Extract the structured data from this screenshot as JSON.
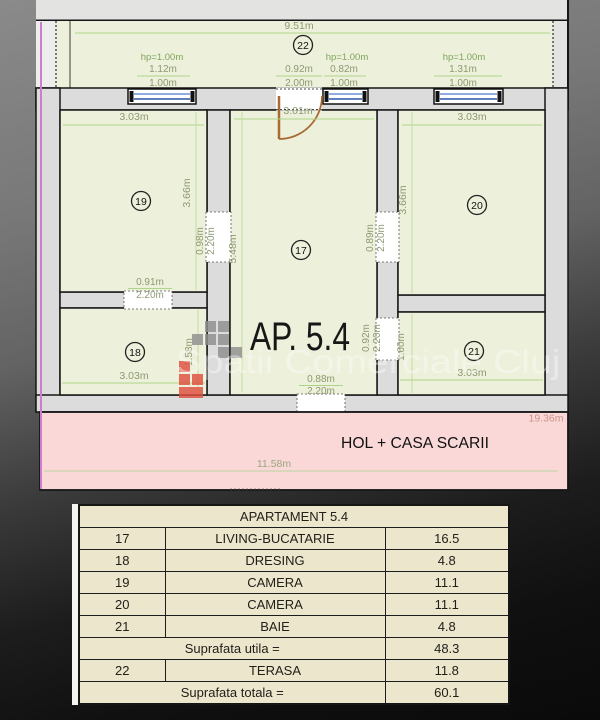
{
  "plan": {
    "apartment_label": "AP. 5.4",
    "watermark_text": "Spatii Comerciale Cluj",
    "terrace": {
      "number": "22",
      "width_total": "9.51m",
      "hp_left": "hp=1.00m",
      "hp_mid": "hp=1.00m",
      "hp_right": "hp=1.00m",
      "win_left_w": "1.12m",
      "win_left_h": "1.00m",
      "door_w": "0.92m",
      "door_h": "2.00m",
      "win_mid_w": "0.82m",
      "win_mid_h": "1.00m",
      "win_right_w": "1.31m",
      "win_right_h": "1.00m"
    },
    "room17": {
      "number": "17",
      "width": "3.01m",
      "height": "5.48m",
      "door_left_w": "0.98m",
      "door_left_h": "2.20m",
      "door_right_w": "0.89m",
      "door_right_h": "2.20m",
      "door_bath_w": "0.92m",
      "door_bath_h": "2.20m",
      "entry_w": "0.88m",
      "entry_h": "2.20m"
    },
    "room18": {
      "number": "18",
      "width": "3.03m",
      "height": "1.58m"
    },
    "room19": {
      "number": "19",
      "width": "3.03m",
      "height": "3.66m",
      "pass_w": "0.91m",
      "pass_h": "2.20m"
    },
    "room20": {
      "number": "20",
      "width": "3.03m",
      "height": "3.66m"
    },
    "room21": {
      "number": "21",
      "width": "3.03m",
      "height": "1.60m"
    },
    "hall": {
      "label": "HOL + CASA SCARII",
      "width": "11.58m",
      "width_total": "19.36m"
    }
  },
  "table": {
    "title": "APARTAMENT 5.4",
    "rows": [
      {
        "id": "17",
        "name": "LIVING-BUCATARIE",
        "area": "16.5"
      },
      {
        "id": "18",
        "name": "DRESING",
        "area": "4.8"
      },
      {
        "id": "19",
        "name": "CAMERA",
        "area": "11.1"
      },
      {
        "id": "20",
        "name": "CAMERA",
        "area": "11.1"
      },
      {
        "id": "21",
        "name": "BAIE",
        "area": "4.8"
      }
    ],
    "useful_label": "Suprafata utila =",
    "useful_value": "48.3",
    "terrace_row": {
      "id": "22",
      "name": "TERASA",
      "area": "11.8"
    },
    "total_label": "Suprafata totala =",
    "total_value": "60.1"
  },
  "colors": {
    "room_fill": "#edf0da",
    "hall_fill": "#fbd8d8",
    "wall_fill": "#dcdcdc",
    "dimension_text": "#8c9a72",
    "dimension_line": "#aed489",
    "hp_text": "#7fa55c",
    "window_blue": "#3e6bbf",
    "door_brown": "#a96a33",
    "boundary_magenta": "#cb7ecb",
    "hall_dim_text": "#cc9488",
    "table_bg": "#ece6cd",
    "logo_gray": "#8f8f8f",
    "logo_red": "#e0503f"
  }
}
